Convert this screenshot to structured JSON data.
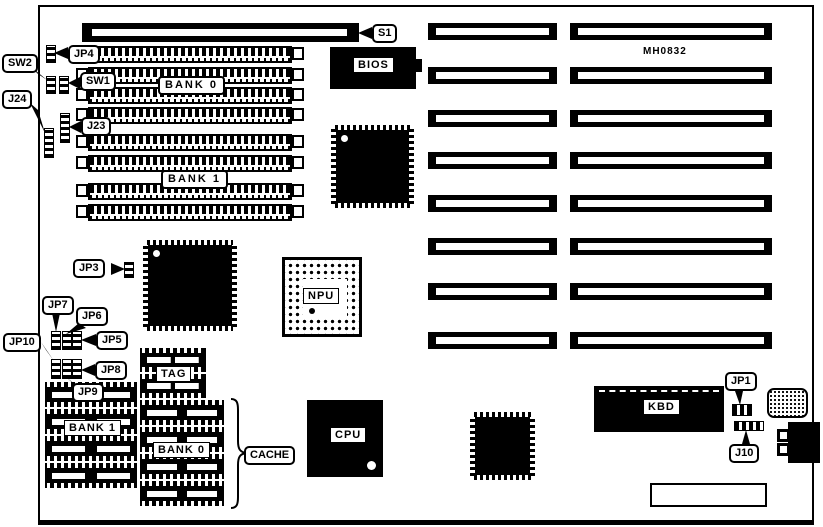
{
  "board": {
    "part_number": "MH0832"
  },
  "callouts": {
    "s1": "S1",
    "jp4": "JP4",
    "sw2": "SW2",
    "sw1": "SW1",
    "j24": "J24",
    "j23": "J23",
    "jp3": "JP3",
    "jp7": "JP7",
    "jp6": "JP6",
    "jp5": "JP5",
    "jp10": "JP10",
    "jp8": "JP8",
    "jp9": "JP9",
    "jp1": "JP1",
    "j10": "J10",
    "cache": "CACHE"
  },
  "chip_labels": {
    "bios": "BIOS",
    "kbd": "KBD",
    "npu": "NPU",
    "cpu": "CPU",
    "tag": "TAG",
    "simm_bank0": "BANK 0",
    "simm_bank1": "BANK 1",
    "cache_bank0": "BANK 0",
    "cache_bank1": "BANK 1"
  }
}
